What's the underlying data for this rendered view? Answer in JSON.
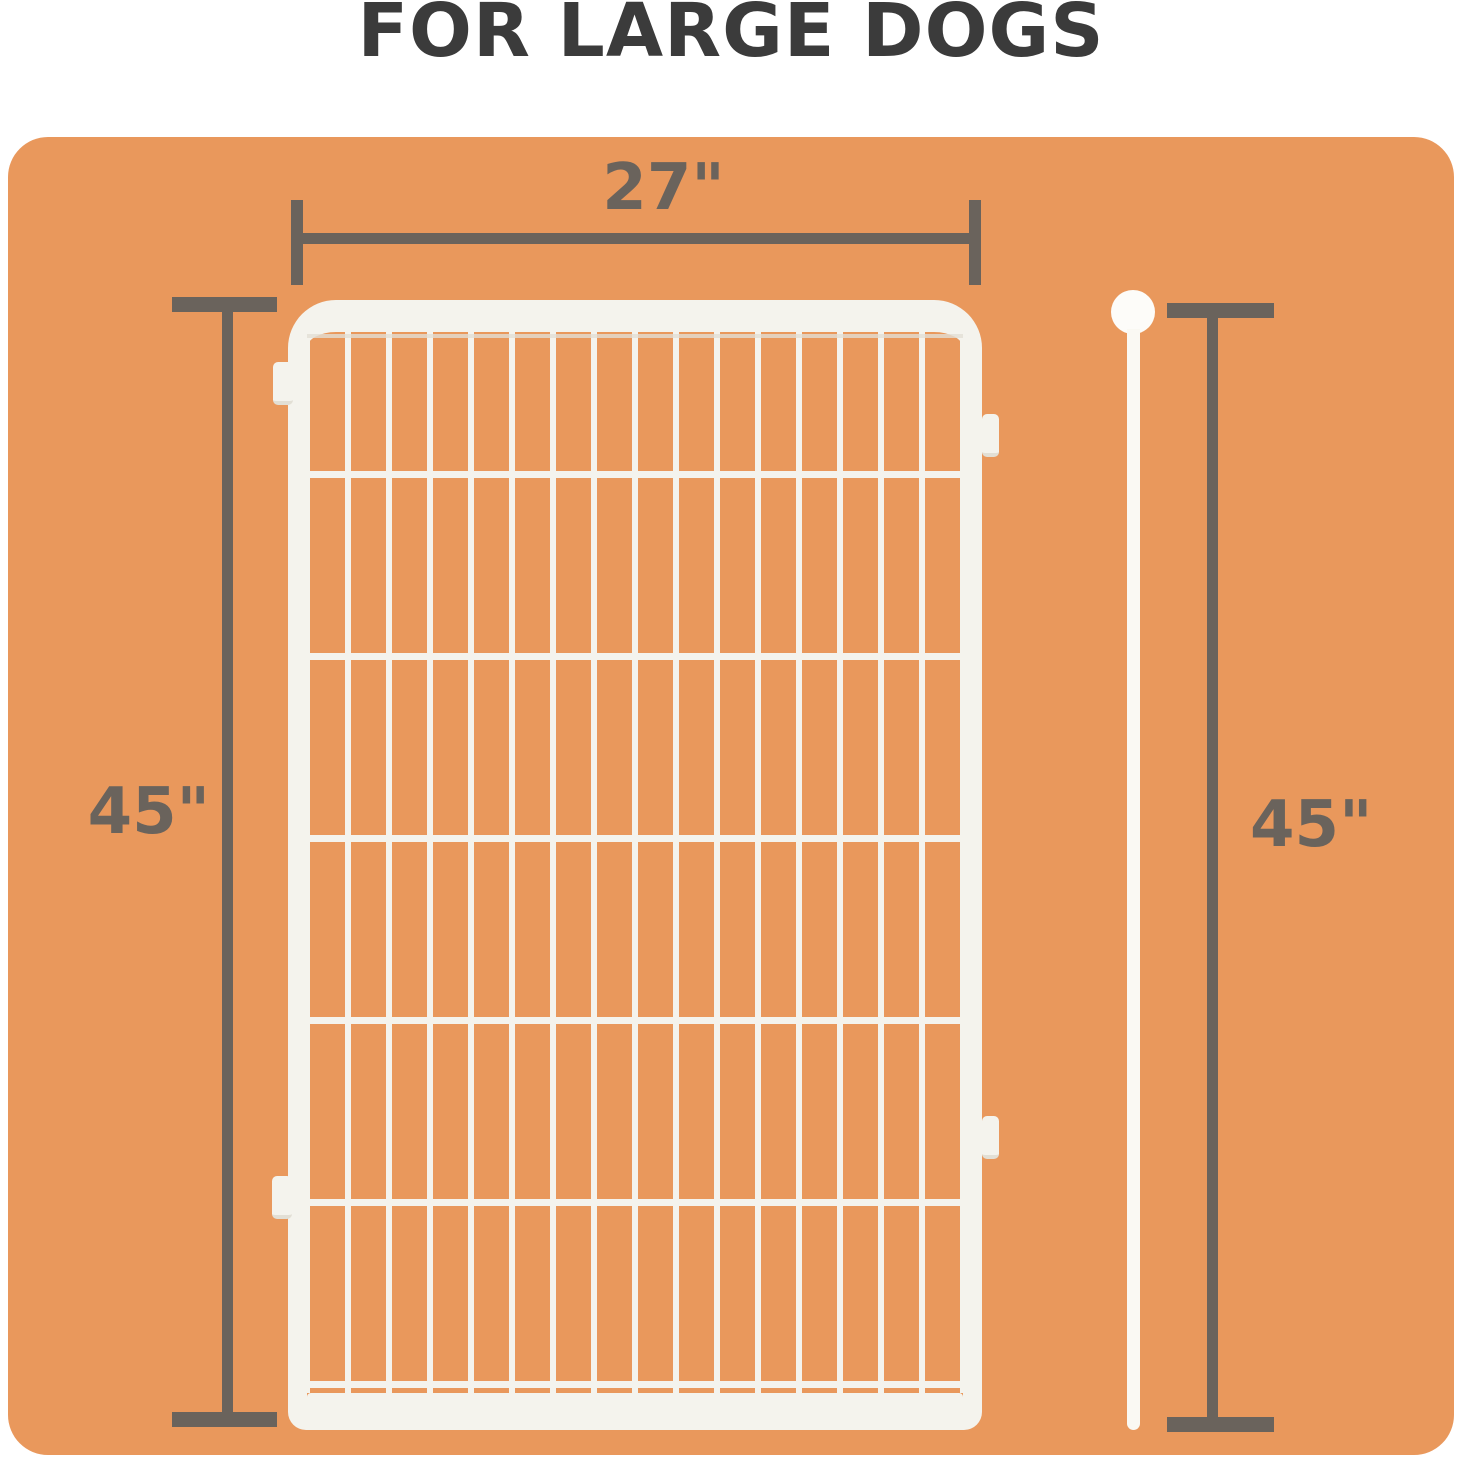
{
  "title": "FOR LARGE DOGS",
  "theme": {
    "page-bg": "#ffffff",
    "board-orange": "#E9985C",
    "dim-gray": "#6A635C",
    "title-color": "#3B3B3B",
    "panel-white": "#F4F3ED",
    "panel-shadow": "#E2DFD5",
    "rod-white": "#FAF9F3",
    "ball-white": "#FDFCF9"
  },
  "dimensions": {
    "width": {
      "label": "27\""
    },
    "height_left": {
      "label": "45\""
    },
    "height_right": {
      "label": "45\""
    }
  },
  "panel": {
    "columns": 16,
    "rows": 6,
    "connector_tabs": 4
  }
}
